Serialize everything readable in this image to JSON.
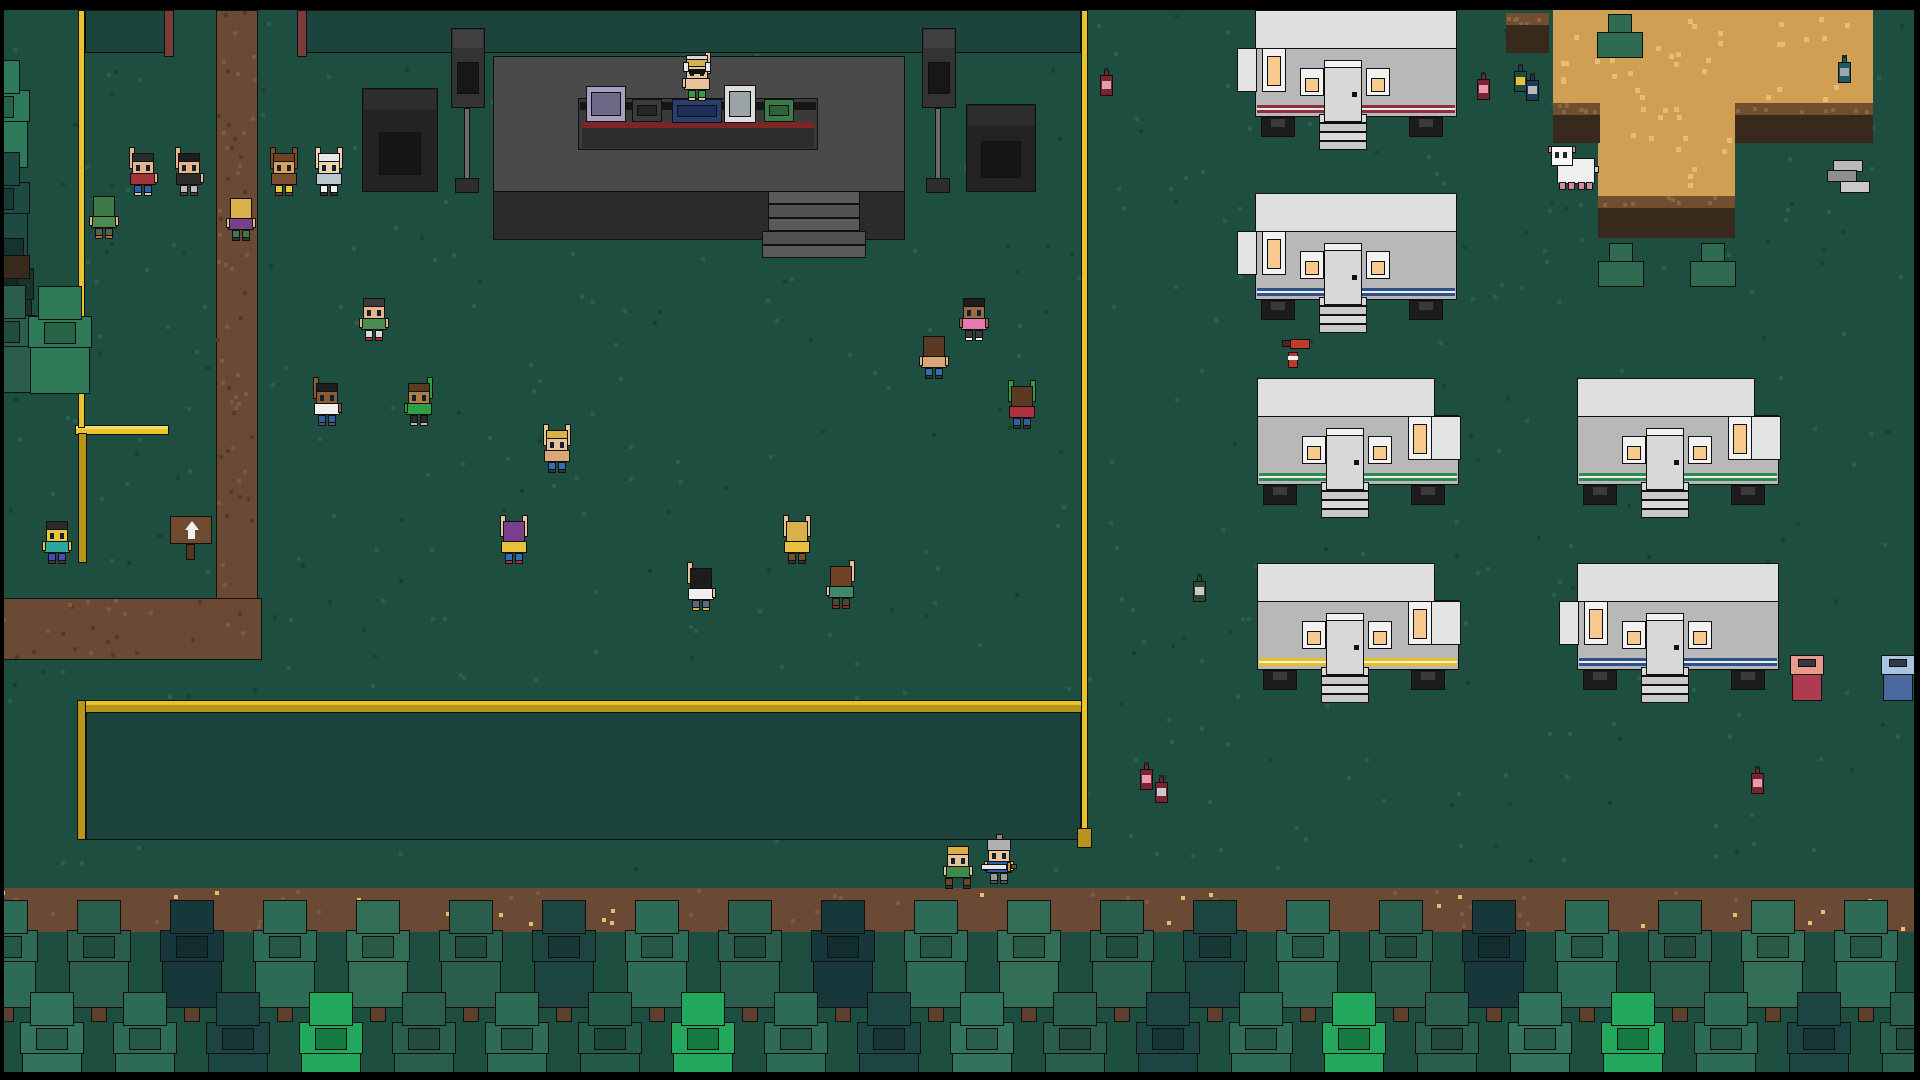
{
  "title": "pixel festival overworld",
  "palette": {
    "grass": "#1d4e3f",
    "grass_dot_light": "#27614f",
    "grass_dot_dark": "#173f32",
    "path": "#6b4a35",
    "path_dot": "#7d5a42",
    "path_dot_dark": "#553a28",
    "sand": "#cfa053",
    "sand_dot": "#e9bc70",
    "rim": "#6f4f30",
    "rim_dot": "#8a6540",
    "cliff": "#372a1d",
    "fence_yellow": "#e8c32e",
    "fence_yellow_dark": "#b8941a",
    "mesh_cell": "#1c443c",
    "mesh_post": "#7a3b3b",
    "stage": "#4a4a4a",
    "stage_front": "#2b2b2b",
    "stage_step": "#5a5a5a",
    "trailer_roof": "#dfdfdf",
    "trailer_body": "#b8b8b8",
    "window_glass": "#f7c98c",
    "door": "#d8d8d8",
    "step": "#d9d9d9",
    "dirt_band": "#6b4a35",
    "black_bar": "#000000"
  },
  "bars": {
    "top": [
      0,
      0,
      1920,
      10
    ],
    "bottom": [
      0,
      1072,
      1920,
      8
    ],
    "left": [
      0,
      0,
      4,
      1080
    ],
    "right": [
      1914,
      0,
      6,
      1080
    ]
  },
  "path": {
    "vertical": [
      216,
      10,
      42,
      592
    ],
    "horizontal": [
      0,
      598,
      262,
      62
    ]
  },
  "sand": {
    "blocks": [
      [
        1553,
        10,
        320,
        95
      ],
      [
        1598,
        103,
        137,
        95
      ]
    ],
    "rims": [
      [
        1553,
        103,
        47,
        12
      ],
      [
        1735,
        103,
        138,
        12
      ],
      [
        1598,
        196,
        137,
        12
      ]
    ],
    "cliffs": [
      [
        1553,
        115,
        47,
        28
      ],
      [
        1735,
        115,
        138,
        28
      ],
      [
        1598,
        208,
        137,
        30
      ]
    ],
    "dirt_patch": {
      "rim": [
        1506,
        13,
        43,
        14
      ],
      "body": [
        1506,
        25,
        43,
        28
      ]
    }
  },
  "fences": {
    "top_mesh": [
      {
        "x": 85,
        "y": 10,
        "w": 88,
        "h": 43
      },
      {
        "x": 299,
        "y": 10,
        "w": 782,
        "h": 43
      }
    ],
    "top_posts": [
      [
        164,
        10,
        10,
        47
      ],
      [
        297,
        10,
        10,
        47
      ]
    ],
    "yellow_left_v": [
      78,
      10,
      7,
      418
    ],
    "yellow_right_v": [
      1081,
      10,
      7,
      822
    ],
    "yellow_right_cap": [
      1077,
      828,
      15,
      20
    ],
    "bottom_rail": [
      77,
      700,
      1011,
      13
    ],
    "bottom_left_post": [
      77,
      700,
      9,
      140
    ],
    "bottom_mesh": [
      86,
      712,
      995,
      128
    ],
    "goal": {
      "bar": [
        75,
        425,
        94,
        10
      ],
      "post": [
        78,
        433,
        9,
        130
      ],
      "net": [
        87,
        437,
        76,
        122
      ]
    }
  },
  "stage": {
    "platform": [
      493,
      56,
      412,
      137
    ],
    "apron": [
      493,
      191,
      412,
      49
    ],
    "steps_block": [
      768,
      191,
      92,
      67
    ],
    "step_rows": 5,
    "table": {
      "frame": [
        578,
        98,
        240,
        52
      ],
      "top_bar": [
        580,
        102,
        236,
        8
      ],
      "stripe": [
        582,
        122,
        232,
        6
      ],
      "stripe_color": "#7a2626",
      "front": [
        582,
        128,
        232,
        20
      ]
    },
    "equipment": [
      {
        "name": "boombox",
        "x": 586,
        "y": 86,
        "w": 40,
        "h": 36,
        "c": "#a79fc0",
        "inner": "#6e6886"
      },
      {
        "name": "mixer",
        "x": 632,
        "y": 99,
        "w": 30,
        "h": 23,
        "c": "#3b3b3b",
        "inner": "#262626"
      },
      {
        "name": "dj-console",
        "x": 672,
        "y": 99,
        "w": 50,
        "h": 24,
        "c": "#2b3f6e",
        "inner": "#1d2f57"
      },
      {
        "name": "synth",
        "x": 724,
        "y": 85,
        "w": 32,
        "h": 38,
        "c": "#dcdcdc",
        "inner": "#9aa4a8"
      },
      {
        "name": "sampler",
        "x": 764,
        "y": 99,
        "w": 30,
        "h": 23,
        "c": "#3d7a4a",
        "inner": "#2e6338"
      }
    ],
    "speaker_boxes": [
      {
        "x": 362,
        "y": 88,
        "w": 76,
        "h": 104
      },
      {
        "x": 966,
        "y": 104,
        "w": 70,
        "h": 88
      }
    ],
    "pole_speakers": [
      {
        "cab": [
          451,
          28,
          34,
          80
        ],
        "pole": [
          464,
          108,
          6,
          72
        ],
        "base": [
          455,
          178,
          24,
          15
        ]
      },
      {
        "cab": [
          922,
          28,
          34,
          80
        ],
        "pole": [
          935,
          108,
          6,
          72
        ],
        "base": [
          926,
          178,
          24,
          15
        ]
      }
    ]
  },
  "trailers": [
    {
      "x": 1255,
      "y": 10,
      "stripe": "#8e3039",
      "endcap": "left",
      "tallwin": "left"
    },
    {
      "x": 1255,
      "y": 193,
      "stripe": "#2d4f8a",
      "endcap": "left",
      "tallwin": "left"
    },
    {
      "x": 1257,
      "y": 378,
      "stripe": "#2e8b4f",
      "endcap": "right",
      "tallwin": "right"
    },
    {
      "x": 1257,
      "y": 563,
      "stripe": "#e8c020",
      "endcap": "right",
      "tallwin": "right"
    },
    {
      "x": 1577,
      "y": 378,
      "stripe": "#2e8b4f",
      "endcap": "right",
      "tallwin": "right"
    },
    {
      "x": 1577,
      "y": 563,
      "stripe": "#2d4f8a",
      "endcap": "left",
      "tallwin": "left"
    }
  ],
  "people": [
    {
      "x": 129,
      "y": 145,
      "skin": "#e8b48a",
      "hair": "#2b2b2b",
      "shirt": "#a8323c",
      "pants": "#2e5fa3",
      "shoe": "#c9c9c9",
      "face": "down",
      "arms": "left"
    },
    {
      "x": 175,
      "y": 145,
      "skin": "#e8b48a",
      "hair": "#1d1d1d",
      "shirt": "#2b2b2b",
      "pants": "#b9b9b9",
      "shoe": "#444444",
      "face": "down",
      "arms": "left"
    },
    {
      "x": 270,
      "y": 145,
      "skin": "#d9a05e",
      "hair": "#6e4326",
      "shirt": "#7a4d2c",
      "pants": "#e8c23a",
      "shoe": "#6e4326",
      "face": "down",
      "arms": "both",
      "sleeve": "#7a4d2c"
    },
    {
      "x": 315,
      "y": 145,
      "skin": "#ecd2ae",
      "hair": "#e8e8e8",
      "shirt": "#b9c7d1",
      "pants": "#f0f0f0",
      "shoe": "#333333",
      "face": "down",
      "arms": "both"
    },
    {
      "x": 90,
      "y": 188,
      "skin": "#e8b48a",
      "hair": "#3f7a46",
      "shirt": "#4c8a52",
      "pants": "#55604f",
      "shoe": "#c06a28",
      "face": "away",
      "arms": "down"
    },
    {
      "x": 227,
      "y": 190,
      "skin": "#e8b48a",
      "hair": "#d9b04a",
      "shirt": "#7a3f8a",
      "pants": "#3f7a46",
      "shoe": "#333333",
      "face": "away",
      "arms": "down"
    },
    {
      "x": 360,
      "y": 290,
      "skin": "#e8b48a",
      "hair": "#3a3a3a",
      "shirt": "#4c8a52",
      "pants": "#d9d9d9",
      "shoe": "#b03040",
      "face": "down",
      "arms": "down"
    },
    {
      "x": 313,
      "y": 375,
      "skin": "#8a5a36",
      "hair": "#1d1d1d",
      "shirt": "#f0f0f0",
      "pants": "#2e5fa3",
      "shoe": "#555555",
      "face": "down",
      "arms": "left"
    },
    {
      "x": 405,
      "y": 375,
      "skin": "#b07a4a",
      "hair": "#5a3a22",
      "shirt": "#2f9e44",
      "pants": "#2b2b2b",
      "shoe": "#b9b9b9",
      "face": "down",
      "arms": "right",
      "sleeve": "#2f9e44"
    },
    {
      "x": 543,
      "y": 422,
      "skin": "#e8c298",
      "hair": "#d9b04a",
      "shirt": "#d9a878",
      "pants": "#2e6fb0",
      "shoe": "#333333",
      "face": "down",
      "arms": "both"
    },
    {
      "x": 500,
      "y": 513,
      "skin": "#e8c298",
      "hair": "#7a3f8a",
      "shirt": "#e8c23a",
      "pants": "#2e6fb0",
      "shoe": "#b03040",
      "face": "away",
      "arms": "both"
    },
    {
      "x": 687,
      "y": 560,
      "skin": "#e8c298",
      "hair": "#1d1d1d",
      "shirt": "#f0f0f0",
      "pants": "#5a6a7a",
      "shoe": "#d9b04a",
      "face": "away",
      "arms": "left"
    },
    {
      "x": 783,
      "y": 513,
      "skin": "#e8c298",
      "hair": "#d9b04a",
      "shirt": "#e8c23a",
      "pants": "#7a4d2c",
      "shoe": "#333333",
      "face": "away",
      "arms": "both"
    },
    {
      "x": 827,
      "y": 558,
      "skin": "#e8c298",
      "hair": "#6e4326",
      "shirt": "#3f8a6a",
      "pants": "#4a4a2e",
      "shoe": "#8a2e2e",
      "face": "away",
      "arms": "right"
    },
    {
      "x": 920,
      "y": 328,
      "skin": "#e8b48a",
      "hair": "#5a3a22",
      "shirt": "#d9a878",
      "pants": "#2e6fb0",
      "shoe": "#333333",
      "face": "away",
      "arms": "down"
    },
    {
      "x": 960,
      "y": 290,
      "skin": "#9a6a42",
      "hair": "#1d1d1d",
      "shirt": "#e878b0",
      "pants": "#3a3a3a",
      "shoe": "#f0f0f0",
      "face": "down",
      "arms": "down"
    },
    {
      "x": 1008,
      "y": 378,
      "skin": "#e8b48a",
      "hair": "#5a3a22",
      "shirt": "#b03040",
      "pants": "#2e5fa3",
      "shoe": "#333333",
      "face": "away",
      "arms": "both",
      "sleeve": "#2f9e44"
    },
    {
      "x": 683,
      "y": 50,
      "skin": "#e8c298",
      "hair": "#d9b04a",
      "shirt": "#e8c298",
      "pants": "#2f9e44",
      "shoe": "#e8c298",
      "face": "down",
      "arms": "right",
      "dj": true
    },
    {
      "x": 43,
      "y": 513,
      "skin": "#e8c23a",
      "hair": "#2b2b2b",
      "shirt": "#2aa8a0",
      "pants": "#4a4ab0",
      "shoe": "#3a3a3a",
      "face": "down",
      "arms": "down"
    },
    {
      "x": 944,
      "y": 838,
      "skin": "#e8c298",
      "hair": "#d9b04a",
      "shirt": "#3f8a46",
      "pants": "#6e4326",
      "shoe": "#333333",
      "face": "down",
      "arms": "down",
      "walk": true
    },
    {
      "x": 985,
      "y": 833,
      "skin": "#e8c298",
      "hair": "#9a9a9a",
      "shirt": "#2e5fa3",
      "pants": "#9a9a9a",
      "shoe": "#555555",
      "face": "down",
      "arms": "down",
      "knight": true
    }
  ],
  "sword": {
    "blade": [
      981,
      864,
      26,
      6
    ],
    "guard": [
      1007,
      862,
      4,
      10
    ],
    "grip": [
      1011,
      864,
      6,
      5
    ]
  },
  "sheep": {
    "body": [
      1557,
      158,
      38,
      26
    ],
    "head": [
      1551,
      146,
      22,
      20
    ],
    "ears": [
      [
        1548,
        146,
        5,
        7
      ],
      [
        1571,
        146,
        5,
        7
      ]
    ],
    "eyes": [
      [
        1555,
        152,
        4,
        6
      ],
      [
        1563,
        152,
        4,
        6
      ]
    ],
    "feet": [
      [
        1559,
        182,
        7,
        8
      ],
      [
        1568,
        182,
        7,
        8
      ],
      [
        1578,
        182,
        7,
        8
      ],
      [
        1586,
        182,
        7,
        8
      ]
    ],
    "tail": [
      1593,
      166,
      6,
      7
    ]
  },
  "chairs": [
    {
      "x": 1597,
      "y": 14
    },
    {
      "x": 1598,
      "y": 243
    },
    {
      "x": 1690,
      "y": 243
    }
  ],
  "chair_color": "#2e6b50",
  "sign": {
    "board": [
      170,
      516,
      42,
      28
    ],
    "post": [
      186,
      544,
      9,
      16
    ],
    "color": "#6e4a30",
    "arrow": "up"
  },
  "bins": [
    {
      "x": 1790,
      "y": 655,
      "lid": "#e89a8a",
      "body": "#b03a50"
    },
    {
      "x": 1881,
      "y": 655,
      "lid": "#a8c4e0",
      "body": "#4a6a9f"
    }
  ],
  "trays": [
    [
      1833,
      160,
      30,
      12,
      "#b9b9b9"
    ],
    [
      1827,
      170,
      30,
      12,
      "#8f8f8f"
    ],
    [
      1840,
      181,
      30,
      12,
      "#c9c9c9"
    ]
  ],
  "extinguisher": {
    "h_body": [
      1290,
      339,
      20,
      10
    ],
    "nozzle": [
      1282,
      340,
      9,
      7
    ],
    "v_body": [
      1288,
      352,
      10,
      16
    ],
    "band": [
      1288,
      356,
      10,
      4
    ]
  },
  "bottles": [
    {
      "x": 1100,
      "y": 68,
      "body": "#7a2430",
      "label": "#e89ab0"
    },
    {
      "x": 1477,
      "y": 72,
      "body": "#7a2430",
      "label": "#e89ab0"
    },
    {
      "x": 1514,
      "y": 64,
      "body": "#1d4a44",
      "label": "#e8c23a"
    },
    {
      "x": 1526,
      "y": 73,
      "body": "#1d3a5a",
      "label": "#b9b9b9"
    },
    {
      "x": 1838,
      "y": 55,
      "body": "#1d5a66",
      "label": "#9aa8b0"
    },
    {
      "x": 1193,
      "y": 574,
      "body": "#2e4a2e",
      "label": "#c9c9c9"
    },
    {
      "x": 1140,
      "y": 762,
      "body": "#7a2430",
      "label": "#e89ab0"
    },
    {
      "x": 1155,
      "y": 775,
      "body": "#7a2430",
      "label": "#c9c9c9"
    },
    {
      "x": 1751,
      "y": 766,
      "body": "#7a2430",
      "label": "#e89ab0"
    }
  ],
  "trees": {
    "dirt_band": [
      0,
      888,
      1920,
      44
    ],
    "back_row": {
      "start": -26,
      "step": 93,
      "y": 900,
      "colors": [
        "#2e6b57",
        "#2a5d4c",
        "#17383a",
        "#2e6b57",
        "#316e55",
        "#2a5d4c",
        "#1d4540",
        "#2e6b57",
        "#2a5d4c",
        "#16383a",
        "#2e6b57",
        "#316e55",
        "#2a5d4c",
        "#1d4540",
        "#2e6b57",
        "#2a5d4c",
        "#17383a",
        "#2e6b57",
        "#2a5d4c",
        "#316e55",
        "#2e6b57"
      ]
    },
    "front_row": {
      "start": 20,
      "step": 93,
      "y": 992,
      "colors": [
        "#327360",
        "#2e6b57",
        "#1c4442",
        "#22a85c",
        "#2a5d4c",
        "#2e6b57",
        "#245a4a",
        "#22a85c",
        "#2e6b57",
        "#1c4442",
        "#327360",
        "#2a5d4c",
        "#1c4442",
        "#2e6b57",
        "#22a85c",
        "#2a5d4c",
        "#327360",
        "#22a85c",
        "#2e6b57",
        "#1c4442",
        "#2a5d4c"
      ]
    },
    "bright_base": "#157a40",
    "side_trees": [
      {
        "x": -34,
        "y": 60,
        "c": "#2e7a5a"
      },
      {
        "x": -34,
        "y": 152,
        "c": "#1d4a42"
      },
      {
        "x": -30,
        "y": 238,
        "c": "#17332e"
      },
      {
        "x": -28,
        "y": 285,
        "c": "#2a5d4c"
      },
      {
        "x": 28,
        "y": 286,
        "c": "#2f7a58"
      }
    ],
    "side_dirt": [
      0,
      255,
      30,
      24
    ]
  },
  "texture_seed": 42
}
